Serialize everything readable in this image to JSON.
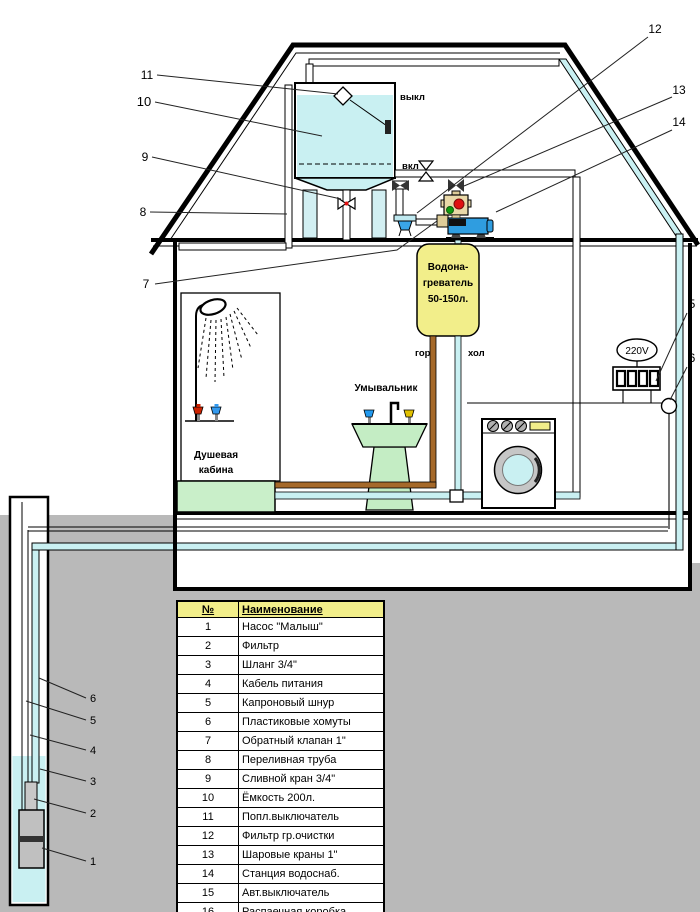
{
  "diagram": {
    "labels": {
      "level_off": "выкл",
      "level_on": "вкл",
      "hot": "гор",
      "cold": "хол",
      "heater_line1": "Водона-",
      "heater_line2": "греватель",
      "heater_line3": "50-150л.",
      "shower_line1": "Душевая",
      "shower_line2": "кабина",
      "sink": "Умывальник",
      "voltage": "220V"
    },
    "callouts": {
      "c1": "1",
      "c2": "2",
      "c3": "3",
      "c4": "4",
      "c5": "5",
      "c6": "6",
      "c7": "7",
      "c8": "8",
      "c9": "9",
      "c10": "10",
      "c11": "11",
      "c12": "12",
      "c13": "13",
      "c14": "14",
      "c15_visible": "5",
      "c16_visible": "6"
    },
    "colors": {
      "water_cyan": "#c9f0f2",
      "ground_gray": "#b9b9b9",
      "heater_yellow": "#f2ee8a",
      "fixture_green": "#c4edc4",
      "pump_blue": "#2f9de0",
      "hot_pipe_brown": "#a5692a",
      "button_red": "#e01010",
      "button_green": "#0f9a0f",
      "control_box_tan": "#e9d9a9",
      "metal_gray": "#c0c0c0"
    }
  },
  "table": {
    "headers": {
      "num": "№",
      "name": "Наименование"
    },
    "rows": [
      {
        "num": "1",
        "name": "Насос \"Малыш\""
      },
      {
        "num": "2",
        "name": "Фильтр"
      },
      {
        "num": "3",
        "name": "Шланг 3/4\""
      },
      {
        "num": "4",
        "name": "Кабель питания"
      },
      {
        "num": "5",
        "name": "Капроновый шнур"
      },
      {
        "num": "6",
        "name": "Пластиковые хомуты"
      },
      {
        "num": "7",
        "name": "Обратный клапан 1\""
      },
      {
        "num": "8",
        "name": "Переливная труба"
      },
      {
        "num": "9",
        "name": "Сливной кран 3/4\""
      },
      {
        "num": "10",
        "name": "Ёмкость 200л."
      },
      {
        "num": "11",
        "name": "Попл.выключатель"
      },
      {
        "num": "12",
        "name": "Фильтр гр.очистки"
      },
      {
        "num": "13",
        "name": "Шаровые краны 1\""
      },
      {
        "num": "14",
        "name": "Станция водоснаб."
      },
      {
        "num": "15",
        "name": "Авт.выключатель"
      },
      {
        "num": "16",
        "name": "Распаечная коробка"
      }
    ]
  }
}
